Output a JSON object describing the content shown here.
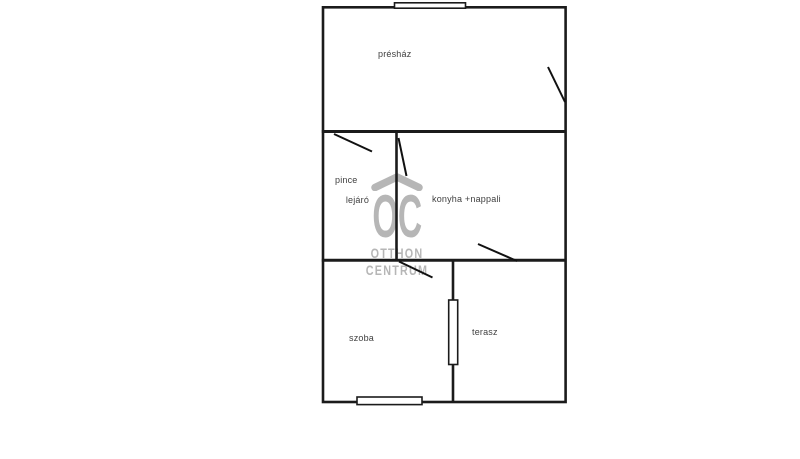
{
  "plan": {
    "rooms": [
      {
        "id": "preshaz",
        "label": "présház"
      },
      {
        "id": "pince-lejaro",
        "label_lines": [
          "pince",
          "lejáró"
        ]
      },
      {
        "id": "konyha-nappali",
        "label": "konyha +nappali"
      },
      {
        "id": "szoba",
        "label": "szoba"
      },
      {
        "id": "terasz",
        "label": "terasz"
      }
    ],
    "features": {
      "windows": 3,
      "door_swings": 5
    }
  },
  "watermark": {
    "logo_icon": "roof-chevron-icon",
    "initials": "OC",
    "line1": "OTTHON",
    "line2": "CENTRUM"
  },
  "colors": {
    "wall": "#1b1b1b",
    "label_text": "#3f3f3f",
    "watermark": "#b6b6b6",
    "background": "#ffffff"
  }
}
